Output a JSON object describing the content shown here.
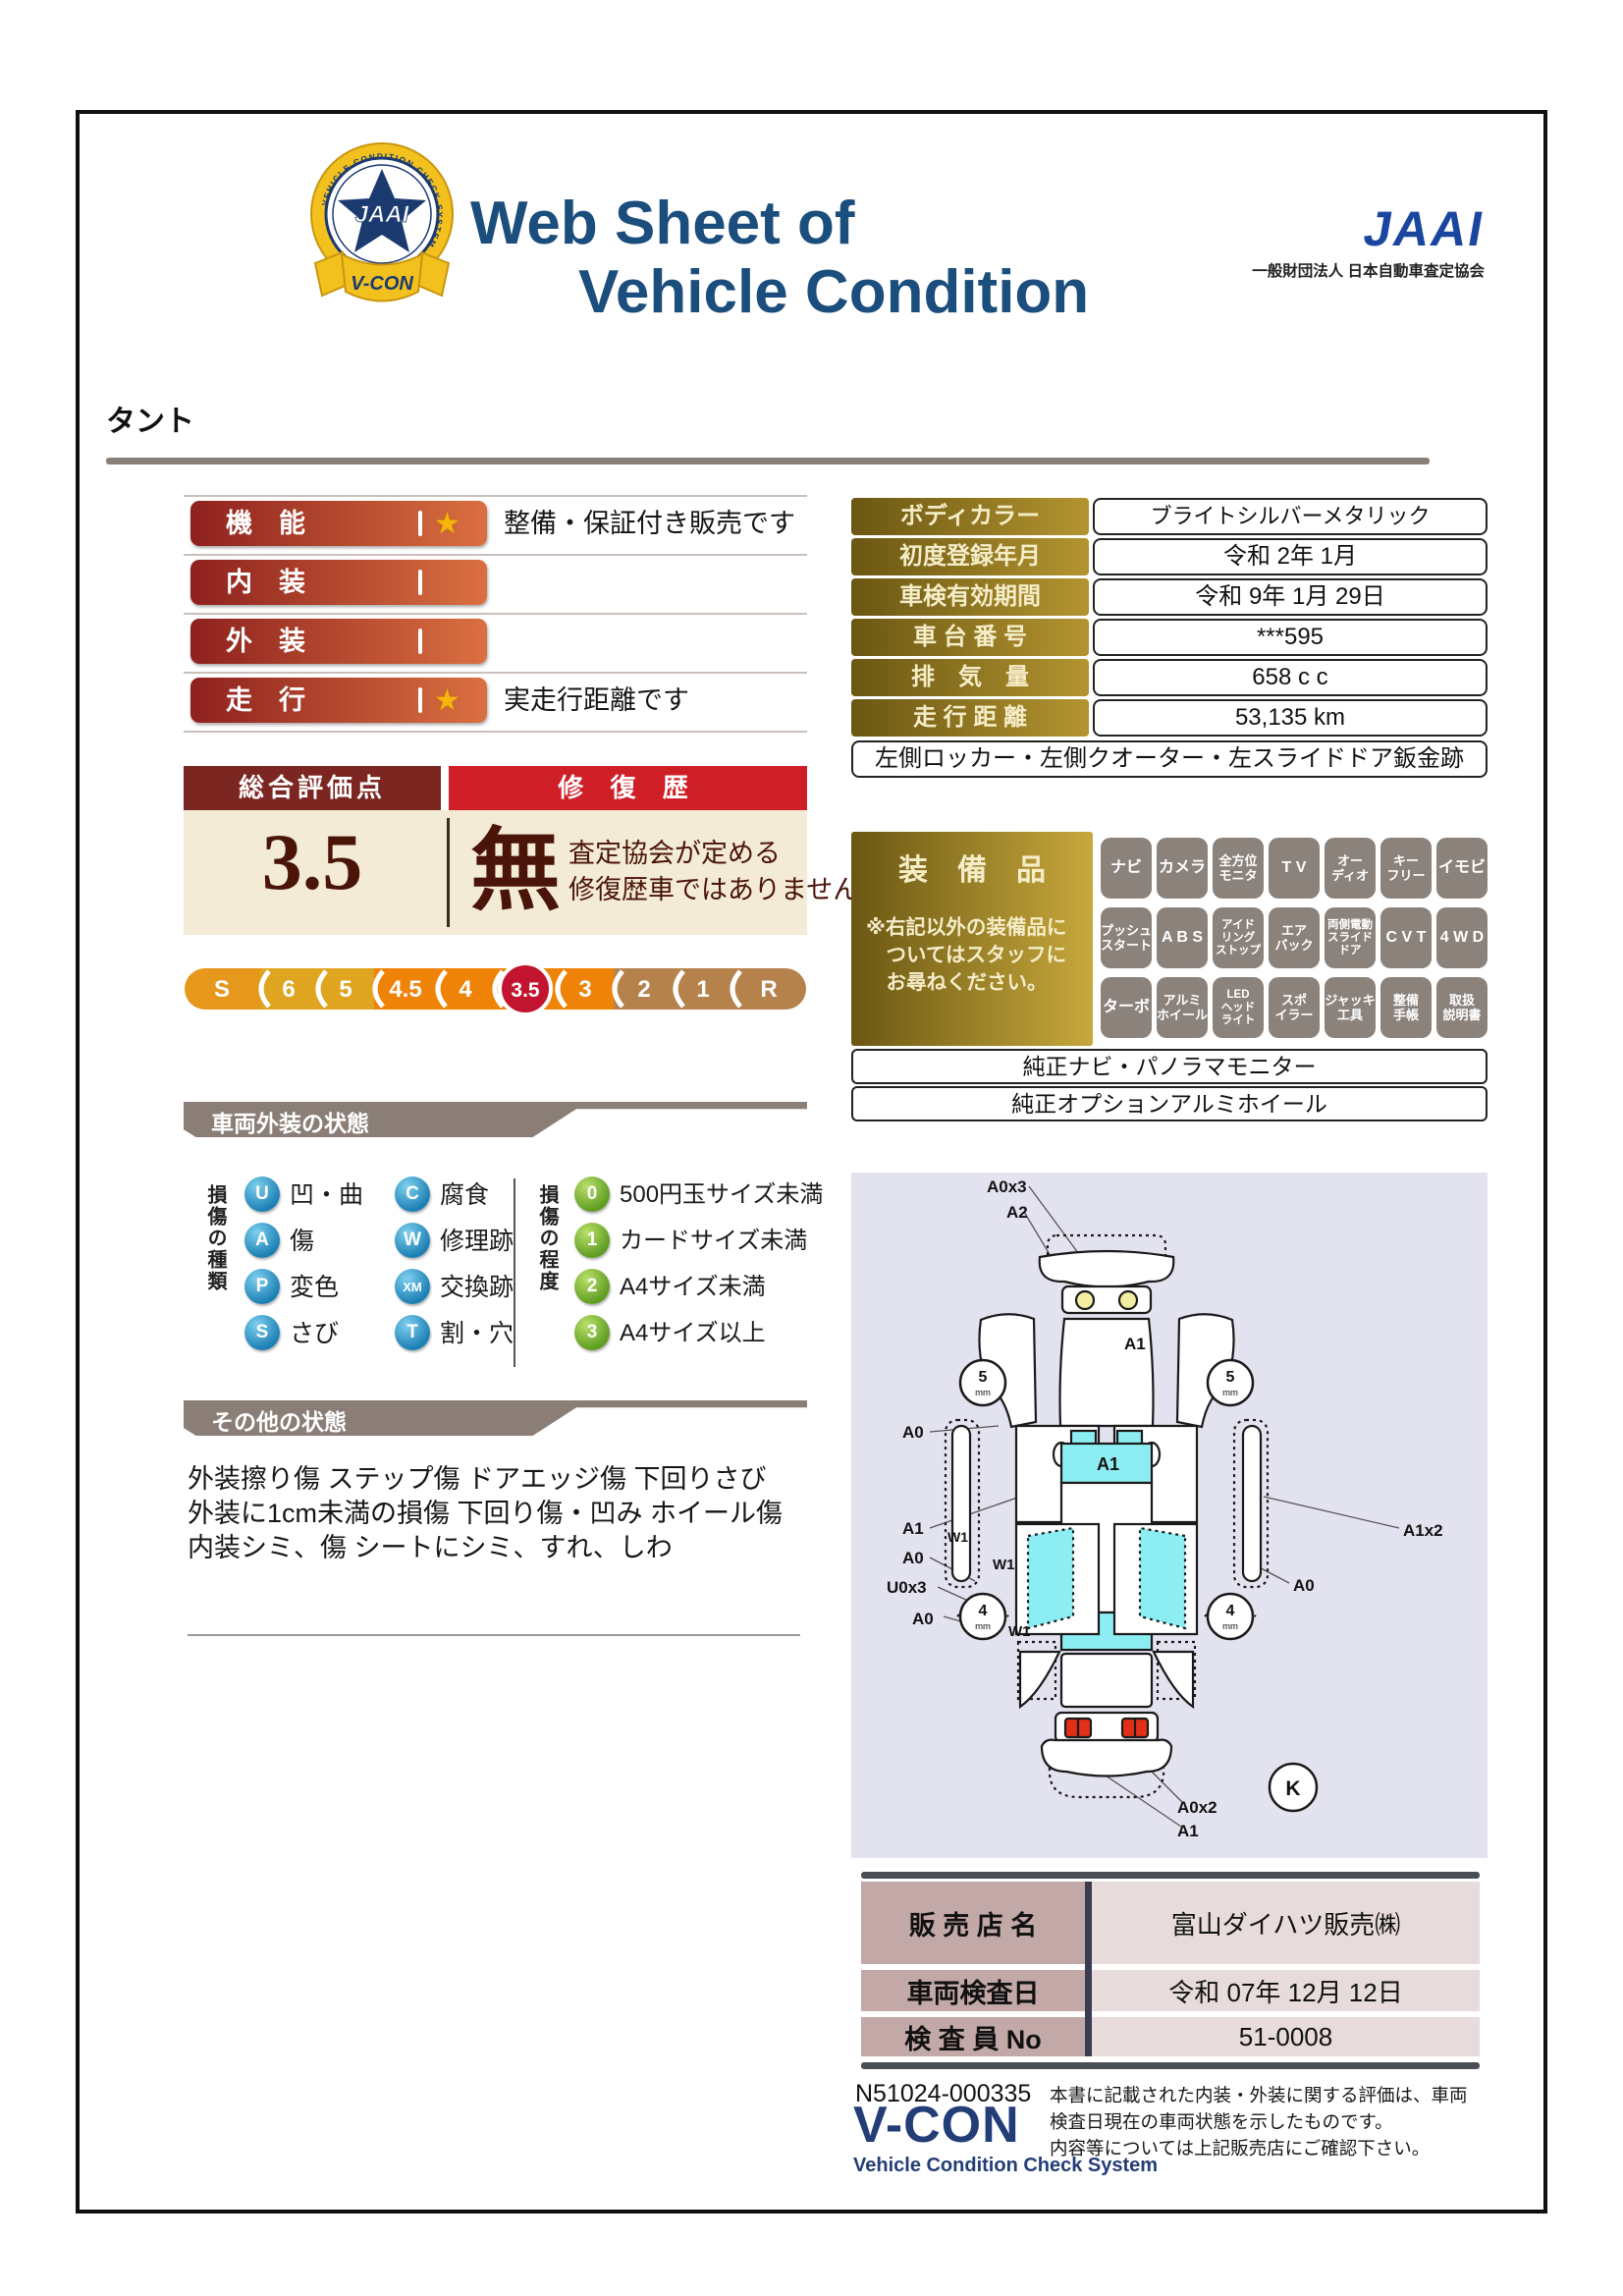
{
  "header": {
    "title1": "Web Sheet of",
    "title2": "Vehicle Condition",
    "jaai": "JAAI",
    "jaai_org": "一般財団法人 日本自動車査定協会",
    "badge_jaai": "JAAI",
    "badge_ring": "VEHICLE CONDITION CHECK SYSTEM",
    "badge_ribbon": "V-CON"
  },
  "vehicle_name": "タント",
  "ratings": {
    "rows": [
      {
        "label": "機　能",
        "star": "★",
        "note": "整備・保証付き販売です"
      },
      {
        "label": "内　装"
      },
      {
        "label": "外　装"
      },
      {
        "label": "走　行",
        "star": "★",
        "note": "実走行距離です"
      }
    ]
  },
  "summary": {
    "score_header": "総合評価点",
    "repair_header": "修 復 歴",
    "score": "3.5",
    "repair_value": "無",
    "repair_note1": "査定協会が定める",
    "repair_note2": "修復歴車ではありません",
    "scale": [
      "S",
      "6",
      "5",
      "4.5",
      "4",
      "3.5",
      "3",
      "2",
      "1",
      "R"
    ]
  },
  "info": {
    "rows": [
      {
        "label": "ボディカラー",
        "value": "ブライトシルバーメタリック"
      },
      {
        "label": "初度登録年月",
        "value": "令和 2年 1月"
      },
      {
        "label": "車検有効期間",
        "value": "令和 9年 1月 29日"
      },
      {
        "label": "車 台 番 号",
        "value": "***595"
      },
      {
        "label": "排　気　量",
        "value": "658 c c"
      },
      {
        "label": "走 行 距 離",
        "value": "53,135 km"
      }
    ],
    "note": "左側ロッカー・左側クオーター・左スライドドア鈑金跡"
  },
  "equipment": {
    "title": "装　備　品",
    "note1": "※右記以外の装備品に",
    "note2": "　ついてはスタッフに",
    "note3": "　お尋ねください。",
    "items": [
      {
        "l1": "ナビ"
      },
      {
        "l1": "カメラ"
      },
      {
        "l1": "全方位",
        "l2": "モニタ"
      },
      {
        "l1": "T V"
      },
      {
        "l1": "オー",
        "l2": "ディオ"
      },
      {
        "l1": "キー",
        "l2": "フリー"
      },
      {
        "l1": "イモビ"
      },
      {
        "l1": "プッシュ",
        "l2": "スタート"
      },
      {
        "l1": "A B S"
      },
      {
        "l1": "アイド",
        "l2": "リング",
        "l3": "ストップ"
      },
      {
        "l1": "エア",
        "l2": "バック"
      },
      {
        "l1": "両側電動",
        "l2": "スライド",
        "l3": "ドア"
      },
      {
        "l1": "C V T"
      },
      {
        "l1": "4 W D"
      },
      {
        "l1": "ターボ"
      },
      {
        "l1": "アルミ",
        "l2": "ホイール"
      },
      {
        "l1": "LED",
        "l2": "ヘッド",
        "l3": "ライト"
      },
      {
        "l1": "スポ",
        "l2": "イラー"
      },
      {
        "l1": "ジャッキ",
        "l2": "工具"
      },
      {
        "l1": "整備",
        "l2": "手帳"
      },
      {
        "l1": "取扱",
        "l2": "説明書"
      }
    ],
    "extra1": "純正ナビ・パノラマモニター",
    "extra2": "純正オプションアルミホイール"
  },
  "exterior": {
    "header": "車両外装の状態",
    "type_label": "損傷の種類",
    "types": [
      {
        "code": "U",
        "label": "凹・曲"
      },
      {
        "code": "C",
        "label": "腐食"
      },
      {
        "code": "A",
        "label": "傷"
      },
      {
        "code": "W",
        "label": "修理跡"
      },
      {
        "code": "P",
        "label": "変色"
      },
      {
        "code": "XM",
        "label": "交換跡"
      },
      {
        "code": "S",
        "label": "さび"
      },
      {
        "code": "T",
        "label": "割・穴"
      }
    ],
    "degree_label": "損傷の程度",
    "degrees": [
      {
        "code": "0",
        "label": "500円玉サイズ未満"
      },
      {
        "code": "1",
        "label": "カードサイズ未満"
      },
      {
        "code": "2",
        "label": "A4サイズ未満"
      },
      {
        "code": "3",
        "label": "A4サイズ以上"
      }
    ]
  },
  "other": {
    "header": "その他の状態",
    "line1": "外装擦り傷 ステップ傷 ドアエッジ傷 下回りさび",
    "line2": "外装に1cm未満の損傷 下回り傷・凹み ホイール傷",
    "line3": "内装シミ、傷 シートにシミ、すれ、しわ"
  },
  "diagram": {
    "a0x3": "A0x3",
    "a2": "A2",
    "hood_a1": "A1",
    "windshield_a1": "A1",
    "left_a0_top": "A0",
    "left_a1": "A1",
    "left_a0_mid": "A0",
    "left_u0x3": "U0x3",
    "left_a0_low": "A0",
    "w1_a": "W1",
    "w1_b": "W1",
    "w1_c": "W1",
    "right_a1x2": "A1x2",
    "right_a0": "A0",
    "rear_a0x2": "A0x2",
    "rear_a1": "A1",
    "k_mark": "K",
    "tread_front": "5",
    "tread_rear": "4",
    "mm_unit": "mm"
  },
  "dealer": {
    "rows": [
      {
        "label": "販 売 店 名",
        "value": "富山ダイハツ販売㈱"
      },
      {
        "label": "車両検査日",
        "value": "令和 07年 12月 12日"
      },
      {
        "label": "検 査 員 No",
        "value": "51-0008"
      }
    ]
  },
  "footer": {
    "doc_no": "N51024-000335",
    "vcon": "V-CON",
    "vcon_sub": "Vehicle Condition Check System",
    "disc1": "本書に記載された内装・外装に関する評価は、車両",
    "disc2": "検査日現在の車両状態を示したものです。",
    "disc3": "内容等については上記販売店にご確認下さい。"
  },
  "colors": {
    "title_navy": "#1b4e7d",
    "bar_red_dark": "#8e211e",
    "bar_red_light": "#da7040",
    "score_header_maroon": "#7c2622",
    "repair_header_red": "#cf1f26",
    "cream": "#f3ebd6",
    "gold_dark": "#6b5713",
    "gold_light": "#c7a83c",
    "badge_gray": "#8b827c",
    "selected_score_red": "#c3142f",
    "window_cyan": "#8ceef2",
    "diagram_bg": "#e3e3f0",
    "dealer_label_rose": "#c3a8a8",
    "banner_taupe": "#8a7e77"
  }
}
